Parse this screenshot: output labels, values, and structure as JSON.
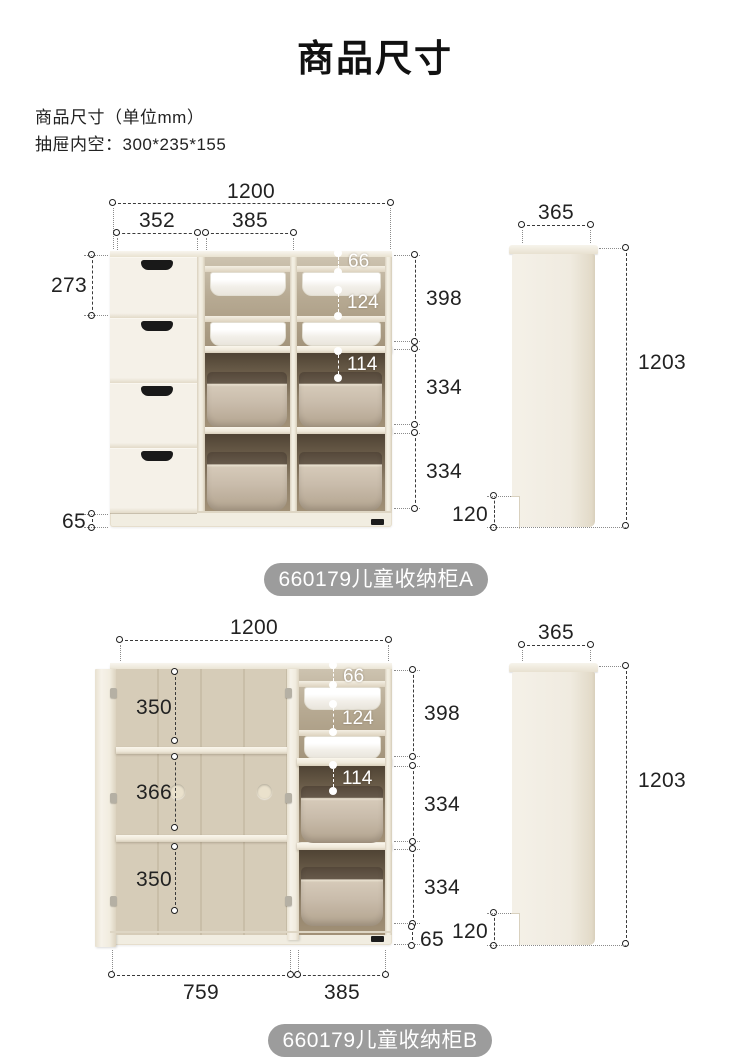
{
  "page": {
    "title": "商品尺寸",
    "subtitle_line1": "商品尺寸（单位mm）",
    "subtitle_line2": "抽屉内空：300*235*155"
  },
  "colors": {
    "background": "#ffffff",
    "cabinet_cream": "#f1ede1",
    "interior_tan": "#b7aa93",
    "interior_dark": "#6e604c",
    "bin_white": "#f3f0ea",
    "bin_taupe": "#c9bcab",
    "label_pill": "#9c9c9c",
    "dimension_line": "#3a3a3a"
  },
  "cabinet_a": {
    "label": "660179儿童收纳柜A",
    "front": {
      "width_total": "1200",
      "width_drawers": "352",
      "width_shelf": "385",
      "drawer_height": "273",
      "plinth_height": "65",
      "top_gap": "66",
      "upper_bin_space": "124",
      "middle_gap": "114",
      "section_top": "398",
      "section_middle": "334",
      "section_bottom": "334"
    },
    "side": {
      "depth": "365",
      "height": "1203",
      "plinth_height": "120"
    }
  },
  "cabinet_b": {
    "label": "660179儿童收纳柜B",
    "front": {
      "width_total": "1200",
      "shelf_top": "350",
      "shelf_middle": "366",
      "shelf_bottom": "350",
      "top_gap": "66",
      "upper_bin_space": "124",
      "middle_gap": "114",
      "section_top": "398",
      "section_middle": "334",
      "section_bottom": "334",
      "width_left": "759",
      "width_right": "385",
      "plinth_height": "65"
    },
    "side": {
      "depth": "365",
      "height": "1203",
      "plinth_height": "120"
    }
  }
}
